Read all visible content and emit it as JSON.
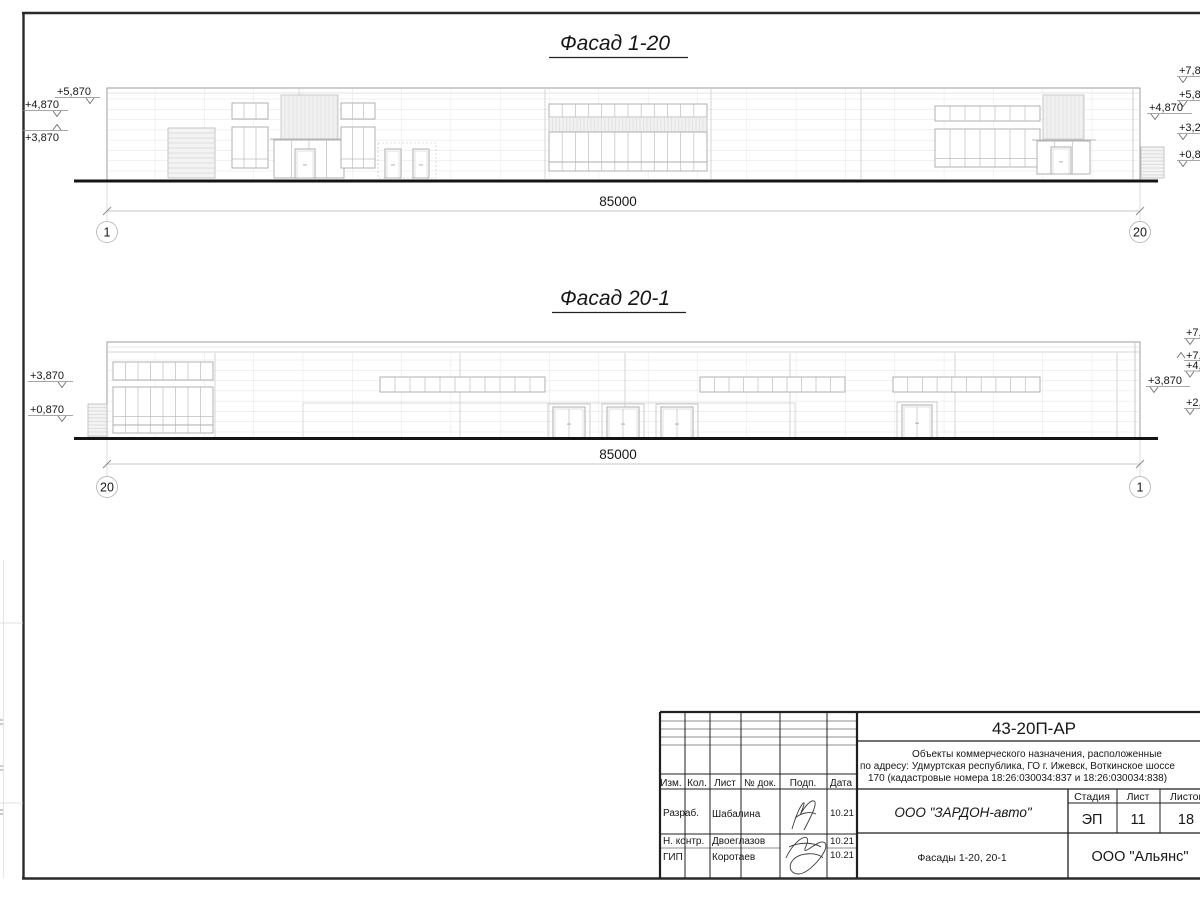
{
  "facade1": {
    "title": "Фасад 1-20",
    "dim": "85000",
    "axis_left": "1",
    "axis_right": "20",
    "marks_left": [
      "+5,870",
      "+4,870",
      "+3,870"
    ],
    "marks_right": [
      "+7,87",
      "+5,87",
      "+4,870",
      "+3,27",
      "+0,870"
    ]
  },
  "facade2": {
    "title": "Фасад 20-1",
    "dim": "85000",
    "axis_left": "20",
    "axis_right": "1",
    "marks_left": [
      "+3,870",
      "+0,870"
    ],
    "marks_right": [
      "+7,8",
      "+7,",
      "+4,8",
      "+3,870",
      "+2,1"
    ]
  },
  "titleblock": {
    "code": "43-20П-АР",
    "description": [
      "Объекты коммерческого назначения, расположенные",
      "по адресу: Удмуртская республика, ГО г. Ижевск, Воткинское шоссе",
      "170 (кадастровые номера 18:26:030034:837 и 18:26:030034:838)"
    ],
    "columns": [
      "Изм.",
      "Кол.",
      "Лист",
      "№ док.",
      "Подп.",
      "Дата"
    ],
    "signers": [
      {
        "role": "Разраб.",
        "name": "Шабалина",
        "date": "10.21"
      },
      {
        "role": "Н. контр.",
        "name": "Двоеглазов",
        "date": "10.21"
      },
      {
        "role": "ГИП",
        "name": "Коротаев",
        "date": "10.21"
      }
    ],
    "client": "ООО \"ЗАРДОН-авто\"",
    "stage_label": "Стадия",
    "sheet_label": "Лист",
    "total_label": "Листов",
    "stage": "ЭП",
    "sheet": "11",
    "total": "18",
    "subject": "Фасады 1-20, 20-1",
    "contractor": "ООО \"Альянс\""
  },
  "colors": {
    "line_dark": "#1f1f1f",
    "line_mid": "#9c9c9c",
    "line_light": "#e3e3e3",
    "ground": "#141414"
  },
  "geometry": {
    "f1": [
      {
        "op": "rect",
        "x": 107,
        "y": 88,
        "w": 1033,
        "h": 92,
        "s": "#9c9c9c",
        "sw": 1,
        "n": "building-outline"
      },
      {
        "op": "hl",
        "x1": 107,
        "x2": 1140,
        "y": 93,
        "s": "#cccccc",
        "sw": 0.6
      },
      {
        "op": "hset",
        "x1": 107,
        "x2": 1140,
        "y1": 99,
        "y2": 171,
        "n": 8,
        "s": "#e3e3e3",
        "sw": 0.5
      },
      {
        "op": "vset",
        "x1": 155,
        "x2": 1092,
        "y1": 89,
        "y2": 179,
        "n": 20,
        "s": "#e6e6e6",
        "sw": 0.5
      },
      {
        "op": "vl",
        "x": 299,
        "y1": 89,
        "y2": 179,
        "s": "#cccccc",
        "sw": 0.8
      },
      {
        "op": "vl",
        "x": 545,
        "y1": 89,
        "y2": 179,
        "s": "#cccccc",
        "sw": 0.8
      },
      {
        "op": "vl",
        "x": 711,
        "y1": 89,
        "y2": 179,
        "s": "#cccccc",
        "sw": 0.8
      },
      {
        "op": "vl",
        "x": 861,
        "y1": 89,
        "y2": 179,
        "s": "#cccccc",
        "sw": 0.8
      },
      {
        "op": "vl",
        "x": 1133,
        "y1": 89,
        "y2": 179,
        "s": "#c2c2c2",
        "sw": 0.8
      },
      {
        "op": "louvH",
        "x": 168,
        "y": 128,
        "w": 47,
        "h": 50,
        "step": 5
      },
      {
        "op": "grid",
        "x": 232,
        "y": 103,
        "w": 36,
        "h": 16,
        "cols": 3,
        "rows": 1
      },
      {
        "op": "grid",
        "x": 232,
        "y": 127,
        "w": 36,
        "h": 41,
        "cols": 3,
        "rows": 2
      },
      {
        "op": "louvV",
        "x": 281,
        "y": 95,
        "w": 57,
        "h": 44,
        "step": 4
      },
      {
        "op": "hl",
        "x1": 270,
        "x2": 348,
        "y": 139,
        "s": "#b5b5b5",
        "sw": 1
      },
      {
        "op": "grid",
        "x": 274,
        "y": 140,
        "w": 70,
        "h": 38,
        "cols": 4,
        "rows": 1
      },
      {
        "op": "door",
        "x": 295,
        "y": 149,
        "w": 20,
        "h": 29,
        "leaves": 1
      },
      {
        "op": "grid",
        "x": 341,
        "y": 103,
        "w": 34,
        "h": 16,
        "cols": 3,
        "rows": 1
      },
      {
        "op": "grid",
        "x": 341,
        "y": 127,
        "w": 34,
        "h": 41,
        "cols": 3,
        "rows": 2
      },
      {
        "op": "dash",
        "x": 378,
        "y": 143,
        "w": 58,
        "h": 35
      },
      {
        "op": "door",
        "x": 385,
        "y": 149,
        "w": 16,
        "h": 29,
        "leaves": 1
      },
      {
        "op": "door",
        "x": 413,
        "y": 149,
        "w": 16,
        "h": 29,
        "leaves": 1
      },
      {
        "op": "grid",
        "x": 549,
        "y": 104,
        "w": 158,
        "h": 13,
        "cols": 12,
        "rows": 1
      },
      {
        "op": "louvV",
        "x": 549,
        "y": 117,
        "w": 158,
        "h": 15,
        "step": 3.5
      },
      {
        "op": "grid",
        "x": 549,
        "y": 132,
        "w": 158,
        "h": 30,
        "cols": 12,
        "rows": 1
      },
      {
        "op": "grid",
        "x": 549,
        "y": 162,
        "w": 158,
        "h": 9,
        "cols": 12,
        "rows": 1
      },
      {
        "op": "grid",
        "x": 935,
        "y": 106,
        "w": 105,
        "h": 15,
        "cols": 7,
        "rows": 1
      },
      {
        "op": "grid",
        "x": 935,
        "y": 129,
        "w": 105,
        "h": 38,
        "cols": 7,
        "rows": 2
      },
      {
        "op": "louvV",
        "x": 1043,
        "y": 95,
        "w": 41,
        "h": 44,
        "step": 4
      },
      {
        "op": "hl",
        "x1": 1032,
        "x2": 1096,
        "y": 140,
        "s": "#b5b5b5",
        "sw": 1
      },
      {
        "op": "grid",
        "x": 1037,
        "y": 141,
        "w": 53,
        "h": 33,
        "cols": 3,
        "rows": 1
      },
      {
        "op": "door",
        "x": 1051,
        "y": 147,
        "w": 20,
        "h": 27,
        "leaves": 1
      },
      {
        "op": "louvH",
        "x": 1141,
        "y": 147,
        "w": 23,
        "h": 31,
        "step": 3.5
      },
      {
        "op": "mark",
        "bind": "facade1.marks_left.0",
        "tx": 57,
        "ty": 95,
        "s": [
          55,
          100,
          97.5
        ],
        "v": "M86 98 L90 103.5 L94 98"
      },
      {
        "op": "mark",
        "bind": "facade1.marks_left.1",
        "tx": 25,
        "ty": 108,
        "s": [
          23,
          68,
          110.5
        ],
        "v": "M53 111 L57 116.5 L61 111"
      },
      {
        "op": "mark",
        "bind": "facade1.marks_left.2",
        "tx": 25,
        "ty": 141,
        "s": [
          23,
          68,
          130.5
        ],
        "v": "M53 130 L57 124.5 L61 130"
      },
      {
        "op": "mark",
        "bind": "facade1.marks_right.0",
        "tx": 1179,
        "ty": 74,
        "s": [
          1177,
          1204,
          76.5
        ],
        "v": "M1179 77 L1183 82.5 L1187 77"
      },
      {
        "op": "mark",
        "bind": "facade1.marks_right.1",
        "tx": 1179,
        "ty": 98,
        "s": [
          1177,
          1204,
          100.5
        ],
        "v": "M1179 101 L1183 106.5 L1187 101"
      },
      {
        "op": "mark",
        "bind": "facade1.marks_right.2",
        "tx": 1149,
        "ty": 111,
        "s": [
          1147,
          1192,
          113.5
        ],
        "v": "M1151 114 L1155 119.5 L1159 114"
      },
      {
        "op": "mark",
        "bind": "facade1.marks_right.3",
        "tx": 1179,
        "ty": 131,
        "s": [
          1177,
          1204,
          133.5
        ],
        "v": "M1179 134 L1183 139.5 L1187 134"
      },
      {
        "op": "mark",
        "bind": "facade1.marks_right.4",
        "tx": 1179,
        "ty": 158,
        "s": [
          1177,
          1204,
          160.5
        ],
        "v": "M1179 161 L1183 166.5 L1187 161"
      }
    ],
    "f2": [
      {
        "op": "rect",
        "x": 107,
        "y": 342,
        "w": 1033,
        "h": 96,
        "s": "#9c9c9c",
        "sw": 1,
        "n": "building-outline"
      },
      {
        "op": "hl",
        "x1": 107,
        "x2": 1140,
        "y": 347,
        "s": "#d5d5d5",
        "sw": 0.6
      },
      {
        "op": "hl",
        "x1": 107,
        "x2": 1140,
        "y": 352,
        "s": "#c6c6c6",
        "sw": 0.8
      },
      {
        "op": "hset",
        "x1": 107,
        "x2": 1140,
        "y1": 360,
        "y2": 432,
        "n": 8,
        "s": "#e3e3e3",
        "sw": 0.5
      },
      {
        "op": "vset",
        "x1": 155,
        "x2": 1092,
        "y1": 353,
        "y2": 438,
        "n": 20,
        "s": "#e6e6e6",
        "sw": 0.5
      },
      {
        "op": "vl",
        "x": 215,
        "y1": 353,
        "y2": 438,
        "s": "#cccccc",
        "sw": 0.8
      },
      {
        "op": "vl",
        "x": 460,
        "y1": 353,
        "y2": 438,
        "s": "#cccccc",
        "sw": 0.8
      },
      {
        "op": "vl",
        "x": 625,
        "y1": 353,
        "y2": 438,
        "s": "#cccccc",
        "sw": 0.8
      },
      {
        "op": "vl",
        "x": 790,
        "y1": 353,
        "y2": 438,
        "s": "#cccccc",
        "sw": 0.8
      },
      {
        "op": "vl",
        "x": 955,
        "y1": 353,
        "y2": 438,
        "s": "#cccccc",
        "sw": 0.8
      },
      {
        "op": "vl",
        "x": 1117,
        "y1": 353,
        "y2": 438,
        "s": "#cccccc",
        "sw": 0.8
      },
      {
        "op": "louvH",
        "x": 88,
        "y": 404,
        "w": 19,
        "h": 33,
        "step": 3.5
      },
      {
        "op": "grid",
        "x": 113,
        "y": 362,
        "w": 100,
        "h": 18,
        "cols": 8,
        "rows": 1
      },
      {
        "op": "grid",
        "x": 113,
        "y": 387,
        "w": 100,
        "h": 38,
        "cols": 8,
        "rows": 2
      },
      {
        "op": "grid",
        "x": 113,
        "y": 425,
        "w": 100,
        "h": 8,
        "cols": 8,
        "rows": 1
      },
      {
        "op": "grid",
        "x": 380,
        "y": 377,
        "w": 165,
        "h": 15,
        "cols": 11,
        "rows": 1
      },
      {
        "op": "grid",
        "x": 700,
        "y": 377,
        "w": 145,
        "h": 15,
        "cols": 10,
        "rows": 1
      },
      {
        "op": "grid",
        "x": 893,
        "y": 377,
        "w": 147,
        "h": 15,
        "cols": 10,
        "rows": 1
      },
      {
        "op": "hl",
        "x1": 303,
        "x2": 795,
        "y": 403,
        "s": "#cfcfcf",
        "sw": 0.8
      },
      {
        "op": "vl",
        "x": 303,
        "y1": 403,
        "y2": 438,
        "s": "#cfcfcf",
        "sw": 0.7
      },
      {
        "op": "vl",
        "x": 795,
        "y1": 403,
        "y2": 438,
        "s": "#cfcfcf",
        "sw": 0.7
      },
      {
        "op": "rect",
        "x": 548,
        "y": 404,
        "w": 42,
        "h": 34,
        "s": "#c2c2c2",
        "sw": 0.8,
        "n": "door-frame"
      },
      {
        "op": "door",
        "x": 553,
        "y": 407,
        "w": 32,
        "h": 31,
        "leaves": 2
      },
      {
        "op": "rect",
        "x": 602,
        "y": 404,
        "w": 42,
        "h": 34,
        "s": "#c2c2c2",
        "sw": 0.8,
        "n": "door-frame"
      },
      {
        "op": "door",
        "x": 607,
        "y": 407,
        "w": 32,
        "h": 31,
        "leaves": 2
      },
      {
        "op": "rect",
        "x": 656,
        "y": 404,
        "w": 42,
        "h": 34,
        "s": "#c2c2c2",
        "sw": 0.8,
        "n": "door-frame"
      },
      {
        "op": "door",
        "x": 661,
        "y": 407,
        "w": 32,
        "h": 31,
        "leaves": 2
      },
      {
        "op": "rect",
        "x": 897,
        "y": 402,
        "w": 40,
        "h": 36,
        "s": "#c2c2c2",
        "sw": 0.8,
        "n": "door-frame"
      },
      {
        "op": "door",
        "x": 902,
        "y": 405,
        "w": 30,
        "h": 33,
        "leaves": 2
      },
      {
        "op": "vl",
        "x": 1135,
        "y1": 343,
        "y2": 438,
        "s": "#bdbdbd",
        "sw": 0.8
      },
      {
        "op": "mark",
        "bind": "facade2.marks_left.0",
        "tx": 30,
        "ty": 379,
        "s": [
          28,
          73,
          381.5
        ],
        "v": "M58 382 L62 387.5 L66 382"
      },
      {
        "op": "mark",
        "bind": "facade2.marks_left.1",
        "tx": 30,
        "ty": 413,
        "s": [
          28,
          73,
          415.5
        ],
        "v": "M58 416 L62 421.5 L66 416"
      },
      {
        "op": "mark",
        "bind": "facade2.marks_right.0",
        "tx": 1186,
        "ty": 336,
        "s": [
          1184,
          1204,
          338.5
        ],
        "v": "M1186 339 L1190 344.5 L1194 339"
      },
      {
        "op": "mark",
        "bind": "facade2.marks_right.1",
        "tx": 1186,
        "ty": 359,
        "s": [
          1184,
          1204,
          360.5
        ],
        "v": "M1177 358 L1181 352.5 L1185 358"
      },
      {
        "op": "mark",
        "bind": "facade2.marks_right.2",
        "tx": 1186,
        "ty": 369,
        "s": [
          1184,
          1204,
          371
        ],
        "v": "M1186 371.5 L1190 377 L1194 371.5"
      },
      {
        "op": "mark",
        "bind": "facade2.marks_right.3",
        "tx": 1148,
        "ty": 384,
        "s": [
          1146,
          1190,
          386.5
        ],
        "v": "M1150 387 L1154 392.5 L1158 387"
      },
      {
        "op": "mark",
        "bind": "facade2.marks_right.4",
        "tx": 1186,
        "ty": 406,
        "s": [
          1184,
          1204,
          408.5
        ],
        "v": "M1186 409 L1190 414.5 L1194 409"
      }
    ]
  }
}
